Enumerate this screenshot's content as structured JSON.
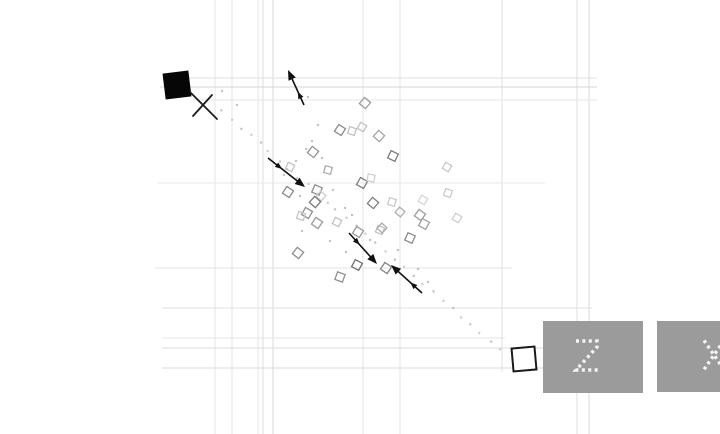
{
  "meta": {
    "width": 720,
    "height": 434,
    "background": "#ffffff"
  },
  "scene": {
    "grid": {
      "vlines": [
        {
          "x": 215,
          "y1": 0,
          "y2": 434,
          "c": "#e4e4e4"
        },
        {
          "x": 232,
          "y1": 0,
          "y2": 434,
          "c": "#e4e4e4"
        },
        {
          "x": 258,
          "y1": 0,
          "y2": 434,
          "c": "#e6e6e6"
        },
        {
          "x": 263,
          "y1": 0,
          "y2": 434,
          "c": "#dedede"
        },
        {
          "x": 273,
          "y1": 0,
          "y2": 434,
          "c": "#d8d8d8"
        },
        {
          "x": 363,
          "y1": 0,
          "y2": 434,
          "c": "#e3e3e3"
        },
        {
          "x": 400,
          "y1": 0,
          "y2": 434,
          "c": "#e6e6e6"
        },
        {
          "x": 502,
          "y1": 0,
          "y2": 372,
          "c": "#e2e2e2"
        },
        {
          "x": 577,
          "y1": 0,
          "y2": 434,
          "c": "#dcdcdc"
        },
        {
          "x": 589,
          "y1": 0,
          "y2": 434,
          "c": "#d8d8d8"
        }
      ],
      "hlines": [
        {
          "y": 78,
          "x1": 168,
          "x2": 597,
          "c": "#dfdfdf"
        },
        {
          "y": 87,
          "x1": 160,
          "x2": 597,
          "c": "#d4d4d4"
        },
        {
          "y": 100,
          "x1": 193,
          "x2": 597,
          "c": "#e6e6e6"
        },
        {
          "y": 183,
          "x1": 158,
          "x2": 545,
          "c": "#e7e7e7"
        },
        {
          "y": 268,
          "x1": 155,
          "x2": 512,
          "c": "#e3e3e3"
        },
        {
          "y": 308,
          "x1": 162,
          "x2": 592,
          "c": "#e0e0e0"
        },
        {
          "y": 338,
          "x1": 162,
          "x2": 505,
          "c": "#e4e4e4"
        },
        {
          "y": 348,
          "x1": 162,
          "x2": 543,
          "c": "#dcdcdc"
        },
        {
          "y": 368,
          "x1": 162,
          "x2": 543,
          "c": "#dadada"
        }
      ]
    },
    "agent_square": {
      "cx": 177,
      "cy": 85,
      "size": 26,
      "rot": -7,
      "color": "#060606"
    },
    "cross_mark": {
      "color": "#1a1a1a",
      "width": 1.8,
      "segments": [
        [
          190,
          92,
          217,
          119
        ],
        [
          212,
          95,
          193,
          116
        ]
      ]
    },
    "goal_square": {
      "cx": 524,
      "cy": 359,
      "size": 23,
      "rot": -5,
      "stroke": "#1a1a1a",
      "fill": "#ffffff",
      "width": 2
    },
    "stray_dot": {
      "x": 552,
      "y": 388,
      "r": 1.3,
      "color": "#333333"
    },
    "arrows": {
      "color": "#111111",
      "shaft_width": 1.6,
      "head_size": 10,
      "mid_head_size": 7,
      "mid_t": 0.38,
      "items": [
        {
          "x1": 304,
          "y1": 105,
          "x2": 288,
          "y2": 70
        },
        {
          "x1": 268,
          "y1": 158,
          "x2": 305,
          "y2": 187
        },
        {
          "x1": 349,
          "y1": 233,
          "x2": 377,
          "y2": 264
        },
        {
          "x1": 422,
          "y1": 293,
          "x2": 391,
          "y2": 265
        }
      ]
    },
    "trail": {
      "x1": 221,
      "y1": 111,
      "x2": 500,
      "y2": 350,
      "count": 30,
      "jitter": 1.6,
      "seed": 7,
      "size": 2.2,
      "colors": [
        "#c3c3c3",
        "#cfcfcf"
      ]
    },
    "diamonds": [
      [
        365,
        103,
        8,
        40,
        "#9a9a9a"
      ],
      [
        340,
        130,
        8,
        32,
        "#8a8a8a"
      ],
      [
        352,
        131,
        7,
        18,
        "#c0c0c0"
      ],
      [
        362,
        127,
        7,
        30,
        "#c2c2c2"
      ],
      [
        379,
        136,
        8,
        42,
        "#a5a5a5"
      ],
      [
        313,
        152,
        8,
        38,
        "#949494"
      ],
      [
        290,
        167,
        7,
        24,
        "#c2c2c2"
      ],
      [
        393,
        156,
        8,
        26,
        "#7a7a7a"
      ],
      [
        328,
        170,
        7,
        14,
        "#ababab"
      ],
      [
        447,
        167,
        7,
        30,
        "#c8c8c8"
      ],
      [
        288,
        192,
        8,
        34,
        "#8a8a8a"
      ],
      [
        317,
        190,
        8,
        24,
        "#8f8f8f"
      ],
      [
        321,
        196,
        7,
        40,
        "#cccccc"
      ],
      [
        362,
        183,
        8,
        30,
        "#7d7d7d"
      ],
      [
        371,
        178,
        7,
        12,
        "#cfcfcf"
      ],
      [
        315,
        202,
        8,
        42,
        "#7a7a7a"
      ],
      [
        307,
        213,
        8,
        30,
        "#8d8d8d"
      ],
      [
        301,
        216,
        7,
        20,
        "#c6c6c6"
      ],
      [
        317,
        223,
        8,
        34,
        "#9b9b9b"
      ],
      [
        337,
        222,
        7,
        26,
        "#c3c3c3"
      ],
      [
        373,
        203,
        8,
        40,
        "#7d7d7d"
      ],
      [
        392,
        202,
        7,
        16,
        "#c9c9c9"
      ],
      [
        423,
        200,
        7,
        30,
        "#d4d4d4"
      ],
      [
        448,
        193,
        7,
        20,
        "#cccccc"
      ],
      [
        420,
        215,
        8,
        36,
        "#9d9d9d"
      ],
      [
        424,
        224,
        8,
        28,
        "#a0a0a0"
      ],
      [
        400,
        212,
        7,
        40,
        "#b0b0b0"
      ],
      [
        380,
        230,
        7,
        22,
        "#c0c0c0"
      ],
      [
        358,
        232,
        8,
        33,
        "#999999"
      ],
      [
        382,
        228,
        7,
        42,
        "#ababab"
      ],
      [
        410,
        238,
        8,
        24,
        "#8c8c8c"
      ],
      [
        457,
        218,
        7,
        30,
        "#cdcdcd"
      ],
      [
        298,
        253,
        8,
        38,
        "#8d8d8d"
      ],
      [
        357,
        265,
        8,
        28,
        "#6f6f6f"
      ],
      [
        386,
        268,
        8,
        34,
        "#848484"
      ],
      [
        340,
        277,
        8,
        20,
        "#919191"
      ]
    ],
    "specks": {
      "size": 2,
      "color": "#b9b9b9",
      "points": [
        [
          318,
          125
        ],
        [
          312,
          141
        ],
        [
          306,
          149
        ],
        [
          322,
          158
        ],
        [
          296,
          161
        ],
        [
          284,
          175
        ],
        [
          333,
          190
        ],
        [
          300,
          196
        ],
        [
          345,
          208
        ],
        [
          352,
          215
        ],
        [
          302,
          231
        ],
        [
          330,
          241
        ],
        [
          370,
          240
        ],
        [
          346,
          252
        ],
        [
          398,
          250
        ],
        [
          418,
          269
        ],
        [
          428,
          282
        ],
        [
          308,
          97
        ],
        [
          237,
          105
        ],
        [
          222,
          91
        ]
      ]
    },
    "key_hints": [
      {
        "label": "2",
        "x": 543,
        "y": 321,
        "w": 100,
        "h": 72,
        "fill": "#9b9b9b",
        "glyph_color": "#f4f4f4",
        "glyph_dx": -6,
        "glyph_dy": 0
      },
      {
        "label": "X",
        "x": 657,
        "y": 321,
        "w": 100,
        "h": 71,
        "fill": "#9b9b9b",
        "glyph_color": "#f4f4f4",
        "glyph_dx": 7,
        "glyph_dy": 0
      }
    ]
  }
}
